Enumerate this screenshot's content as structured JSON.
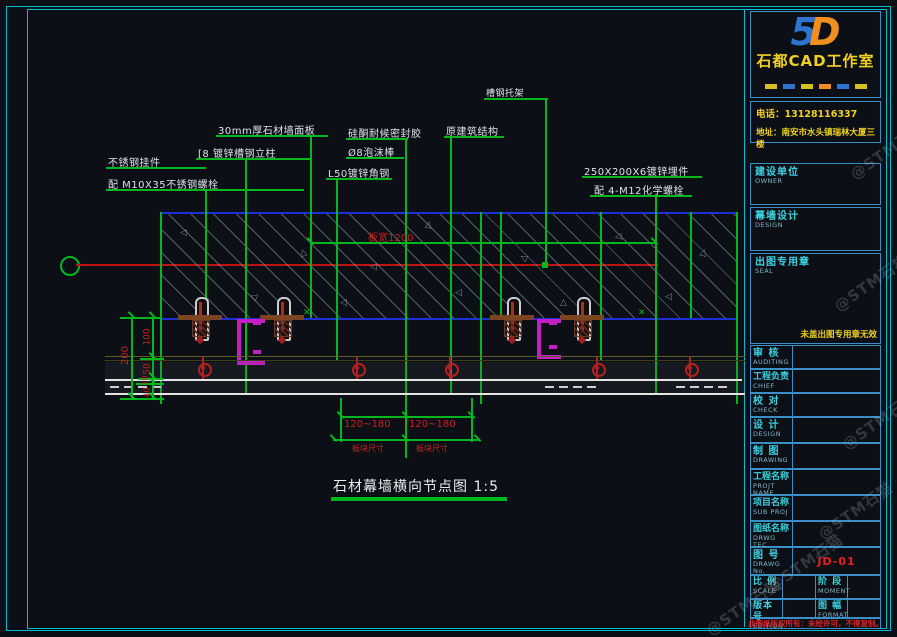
{
  "title_block": {
    "logo": {
      "left": "5",
      "right": "D"
    },
    "studio_name": "石都CAD工作室",
    "contact": {
      "phone": "电话：13128116337",
      "address": "地址：南安市水头镇瑞林大厦三楼"
    },
    "stamps": [
      {
        "label": "建设单位",
        "sub": "OWNER"
      },
      {
        "label": "幕墙设计",
        "sub": "DESIGN"
      },
      {
        "label": "出图专用章",
        "sub": "SEAL"
      }
    ],
    "seal_note": "未盖出图专用章无效",
    "rows": [
      {
        "label": "审  核",
        "sub": "AUDITING"
      },
      {
        "label": "工程负责",
        "sub": "CHIEF"
      },
      {
        "label": "校  对",
        "sub": "CHECK"
      },
      {
        "label": "设  计",
        "sub": "DESIGN"
      },
      {
        "label": "制  图",
        "sub": "DRAWING"
      },
      {
        "label": "工程名称",
        "sub": "PROJT NAME"
      },
      {
        "label": "项目名称",
        "sub": "SUB PROJ"
      },
      {
        "label": "图纸名称",
        "sub": "DRWG TEC"
      }
    ],
    "drawing_no": {
      "label": "图  号",
      "sub": "DRAWG No.",
      "value": "JD-01"
    },
    "pair_rows": [
      {
        "left": {
          "label": "比 例",
          "sub": "SCALE"
        },
        "right": {
          "label": "阶 段",
          "sub": "MOMENT"
        }
      },
      {
        "left": {
          "label": "版本号",
          "sub": "EDITION"
        },
        "right": {
          "label": "图 幅",
          "sub": "FORMAT"
        }
      }
    ],
    "copyright_note": "此图纸版权所有：未经许可，不得复制。"
  },
  "drawing": {
    "title": "石材幕墙横向节点图 1:5",
    "annotations": {
      "hanger_line1": "不锈钢挂件",
      "hanger_line2": "配 M10X35不锈钢螺栓",
      "column": "[8 镀锌槽钢立柱",
      "panel": "30mm厚石材墙面板",
      "sealant": "硅酮耐候密封胶",
      "foam": "Ø8泡沫棒",
      "angle": "L50镀锌角钢",
      "structure": "原建筑结构",
      "bracket": "槽钢托架",
      "embed_line1": "250X200X6镀锌埋件",
      "embed_line2": "配 4-M12化学螺栓"
    },
    "dimensions": {
      "panel_width": "板宽1200",
      "span_left": "120~180",
      "span_right": "120~180",
      "span_note_left": "板块尺寸",
      "span_note_right": "板块尺寸",
      "v_total": "200",
      "v_seg_1": "100",
      "v_seg_2": "50",
      "v_seg_3": "10",
      "v_seg_4": "40"
    }
  },
  "watermark_text": "@STM石猫",
  "colors": {
    "accent_green": "#00b81e",
    "accent_red": "#c62020",
    "accent_cyan": "#00bcd0",
    "accent_blue": "#2030d8",
    "accent_yellow": "#f0d022",
    "accent_magenta": "#c41fc4",
    "drawing_no_red": "#e82020"
  }
}
